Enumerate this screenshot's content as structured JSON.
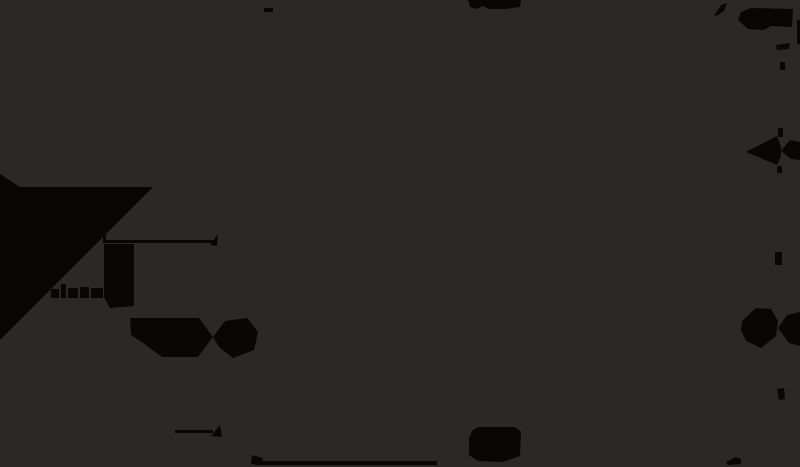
{
  "canvas": {
    "width": 800,
    "height": 467,
    "background_color": "#2a2928",
    "ink_color": "#080706",
    "description": "dark technical dimension drawing, content mostly cropped at edges, no legible text"
  },
  "shapes": [
    {
      "name": "top-edge-dash",
      "type": "rect",
      "x": 264,
      "y": 8,
      "w": 9,
      "h": 4
    },
    {
      "name": "top-center-number-blob",
      "type": "polygon",
      "points": "468,0 521,0 520,7 505,9 488,9 483,6 477,9 470,7"
    },
    {
      "name": "top-right-leader-arrow",
      "type": "polygon",
      "points": "714,16 721,5 727,3 724,11 718,15"
    },
    {
      "name": "top-right-label-blob",
      "type": "polygon",
      "points": "751,8 793,9 792,27 771,26 764,30 748,29 738,20 741,12"
    },
    {
      "name": "top-right-dash",
      "type": "polygon",
      "points": "776,45 790,43 789,49 777,50"
    },
    {
      "name": "right-edge-sliver",
      "type": "rect",
      "x": 797,
      "y": 20,
      "w": 3,
      "h": 24
    },
    {
      "name": "right-extension-tick-1",
      "type": "rect",
      "x": 780,
      "y": 62,
      "w": 5,
      "h": 8
    },
    {
      "name": "right-extension-tick-2",
      "type": "rect",
      "x": 778,
      "y": 128,
      "w": 5,
      "h": 9
    },
    {
      "name": "right-dim-arrowhead-left",
      "type": "polygon",
      "points": "746,152 777,136 781,147 781,156 777,165"
    },
    {
      "name": "right-dim-arrow-tail",
      "type": "polygon",
      "points": "781,151 790,140 800,142 800,160 791,159"
    },
    {
      "name": "right-extension-tick-3",
      "type": "rect",
      "x": 777,
      "y": 166,
      "w": 5,
      "h": 7
    },
    {
      "name": "right-extension-tick-4",
      "type": "rect",
      "x": 775,
      "y": 252,
      "w": 7,
      "h": 13
    },
    {
      "name": "right-bowtie-arrow-left",
      "type": "polygon",
      "points": "742,321 756,308 771,309 778,321 776,336 761,348 746,341 741,330"
    },
    {
      "name": "right-bowtie-arrow-right",
      "type": "polygon",
      "points": "778,328 787,315 800,312 800,346 789,343"
    },
    {
      "name": "right-extension-tick-5",
      "type": "polygon",
      "points": "777,389 784,388 785,399 779,400"
    },
    {
      "name": "left-part-silhouette",
      "type": "polygon",
      "points": "0,174 20,187 153,187 0,340"
    },
    {
      "name": "left-label-blob",
      "type": "polygon",
      "points": "104,244 134,244 134,306 110,308 104,297"
    },
    {
      "name": "left-label-mark-1",
      "type": "rect",
      "x": 51,
      "y": 289,
      "w": 8,
      "h": 9
    },
    {
      "name": "left-label-mark-2",
      "type": "rect",
      "x": 61,
      "y": 284,
      "w": 5,
      "h": 14
    },
    {
      "name": "left-label-mark-3",
      "type": "rect",
      "x": 68,
      "y": 288,
      "w": 10,
      "h": 10
    },
    {
      "name": "left-label-mark-4",
      "type": "rect",
      "x": 80,
      "y": 287,
      "w": 9,
      "h": 11
    },
    {
      "name": "left-label-mark-5",
      "type": "rect",
      "x": 91,
      "y": 288,
      "w": 12,
      "h": 10
    },
    {
      "name": "mid-dim-line",
      "type": "rect",
      "x": 104,
      "y": 240,
      "w": 110,
      "h": 3
    },
    {
      "name": "mid-dim-extension-tick",
      "type": "rect",
      "x": 103,
      "y": 233,
      "w": 3,
      "h": 10
    },
    {
      "name": "mid-dim-arrowhead",
      "type": "polygon",
      "points": "218,234 210,245 217,246"
    },
    {
      "name": "lower-bowtie-arrow-left",
      "type": "polygon",
      "points": "130,318 199,318 213,337 198,357 162,357 143,343 131,335"
    },
    {
      "name": "lower-bowtie-arrow-right",
      "type": "polygon",
      "points": "213,337 225,321 247,318 258,332 254,350 233,358 219,347"
    },
    {
      "name": "bottom-dim-line",
      "type": "rect",
      "x": 175,
      "y": 430,
      "w": 38,
      "h": 3
    },
    {
      "name": "bottom-dim-arrowhead",
      "type": "polygon",
      "points": "220,425 211,436 222,437"
    },
    {
      "name": "bottom-leader-wedge",
      "type": "polygon",
      "points": "252,455 263,458 262,465 251,464"
    },
    {
      "name": "bottom-edge-line",
      "type": "rect",
      "x": 255,
      "y": 461,
      "w": 182,
      "h": 4
    },
    {
      "name": "bottom-center-number-blob",
      "type": "polygon",
      "points": "472,431 478,427 515,427 521,432 520,456 503,462 478,461 469,455 469,438"
    },
    {
      "name": "bottom-right-leader-arrow",
      "type": "polygon",
      "points": "726,462 736,457 741,459 741,464 728,465"
    }
  ]
}
